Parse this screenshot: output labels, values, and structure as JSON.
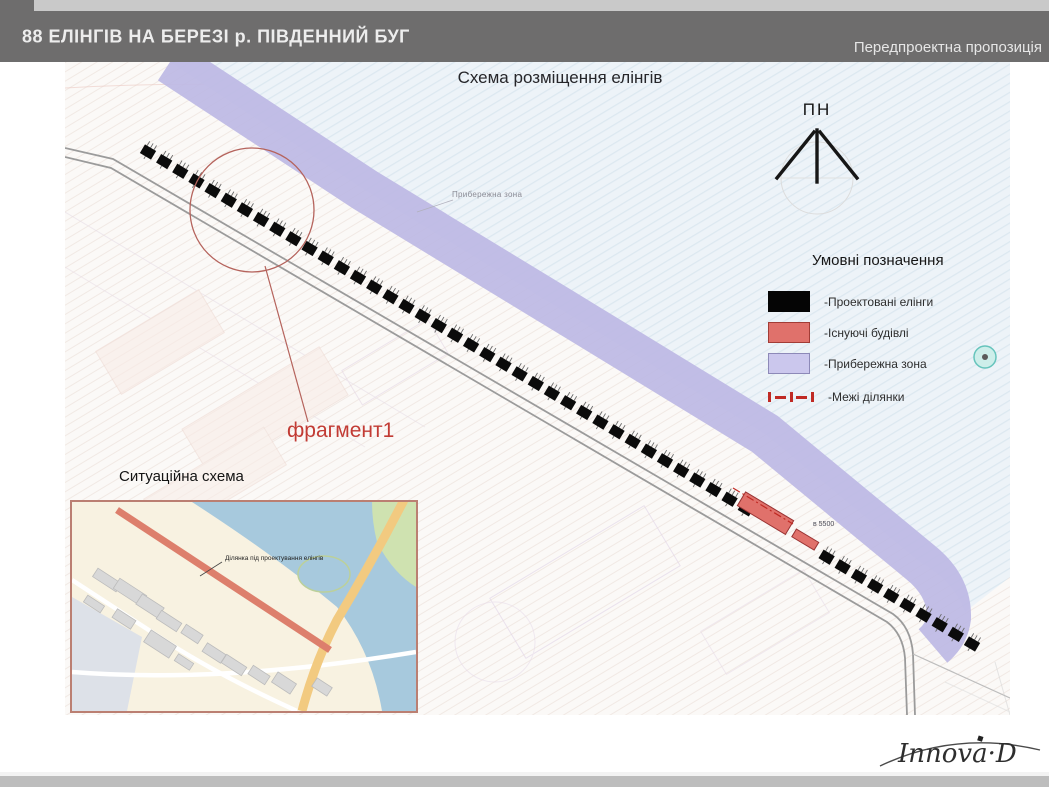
{
  "header": {
    "title": "88 ЕЛІНГІВ НА БЕРЕЗІ р. ПІВДЕННИЙ БУГ",
    "subtitle_right": "Передпроектна пропозиція"
  },
  "plan": {
    "title": "Схема розміщення елінгів",
    "north_label": "ПН",
    "water_label": "Прибережна зона",
    "fragment_label": "фрагмент1",
    "dimension_label": "в 5500",
    "boathouses": {
      "count": 52,
      "gap_indices": [
        38,
        39,
        40,
        41
      ]
    }
  },
  "legend": {
    "title": "Умовні позначення",
    "items": [
      {
        "name": "projected-boathouses",
        "label": "-Проектовані елінги",
        "color": "#000000"
      },
      {
        "name": "existing-buildings",
        "label": "-Існуючі будівлі",
        "color": "#e0716b"
      },
      {
        "name": "coastal-zone",
        "label": "-Прибережна зона",
        "color": "#cbc7ed"
      },
      {
        "name": "site-boundaries",
        "label": "-Межі ділянки",
        "color": "#c02a24"
      }
    ]
  },
  "inset": {
    "title": "Ситуаційна схема",
    "site_label": "Ділянка під проектування елінгів"
  },
  "footer": {
    "logo": "Innova·D"
  },
  "colors": {
    "header_bar": "#6e6d6d",
    "water": "#edf3f8",
    "coastal_band": "#bdb9e4",
    "accent_red": "#c23b34",
    "road": "#9b9b9b"
  }
}
